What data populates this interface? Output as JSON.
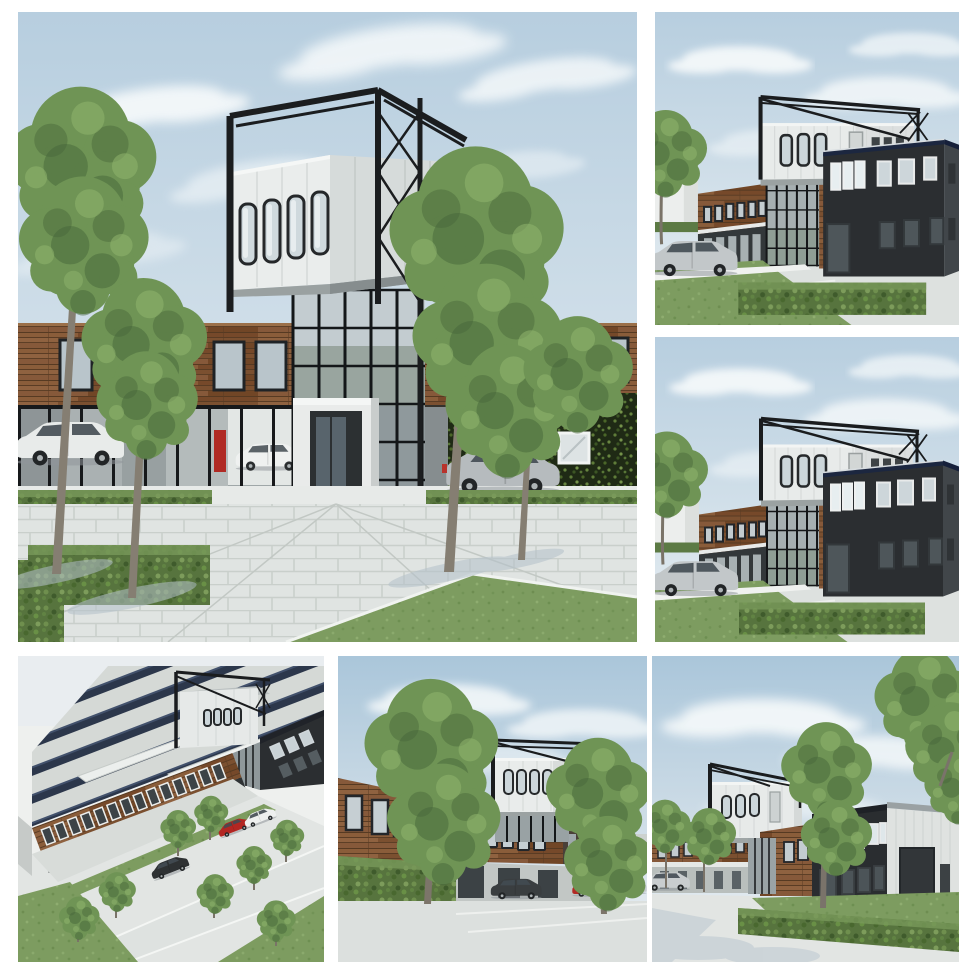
{
  "collage": {
    "description": "Collage of six 3D architectural renderings of a timber-clad business building with a black steel-framed white box tower",
    "panel_count": 6,
    "layout": "large hero image top-left, two stacked views top-right, three views across the bottom"
  },
  "panels": [
    {
      "id": "front-elevation",
      "alt": "Street-level front view: timber-clad office band over a glass ground floor, black steel frame tower carrying a white cantilevered box with four porthole windows, green ivy wall, trees, hedges, parked estate car and minivan on a paved plaza"
    },
    {
      "id": "corner-view-a",
      "alt": "Corner view: dark charcoal two-storey office block beside a timber-clad wing and glass stair tower, white box volume in an open black steel frame above, silver minivan and trimmed hedge"
    },
    {
      "id": "corner-view-b",
      "alt": "Second, nearly identical corner view of the dark office block, timber wing and steel-framed white box volume"
    },
    {
      "id": "aerial-view",
      "alt": "Aerial view: large industrial hall roof covered with rows of solar panels, timber-clad office facade, steel-framed white box tower on the roof, parking lot with red, white and black vehicles, young trees and grass strips"
    },
    {
      "id": "street-view",
      "alt": "Street view along the timber facade with two large trees, long hedge in the foreground, dark pickup truck, red and silver cars parked at the entrance below the white box tower"
    },
    {
      "id": "driveway-view",
      "alt": "Driveway view: dark charcoal office block and light grey warehouse with a large loading door, lawn and hedge in front, trees, silver car and tree shadows on the pavement"
    }
  ],
  "palette": {
    "sky_blue": "#b7cedf",
    "sky_pale": "#e9eff3",
    "cloud_white": "#f7fafb",
    "steel_black": "#1b1d1f",
    "box_white": "#e9eceb",
    "box_grey": "#d6dbda",
    "wood_brown": "#7f5534",
    "wood_dark": "#5a3c24",
    "charcoal_building": "#2b2e31",
    "navy_roofline": "#1c2740",
    "glass_grey": "#9fa7a8",
    "ivy_green": "#1f2a15",
    "hedge_green": "#57743e",
    "grass_green": "#7d9c60",
    "tree_green": "#6f9455",
    "pavement_grey": "#dfe3e1",
    "solar_panel": "#232e44",
    "car_red": "#b22a24",
    "car_silver": "#c2c7c9",
    "car_white": "#e8ebea"
  }
}
